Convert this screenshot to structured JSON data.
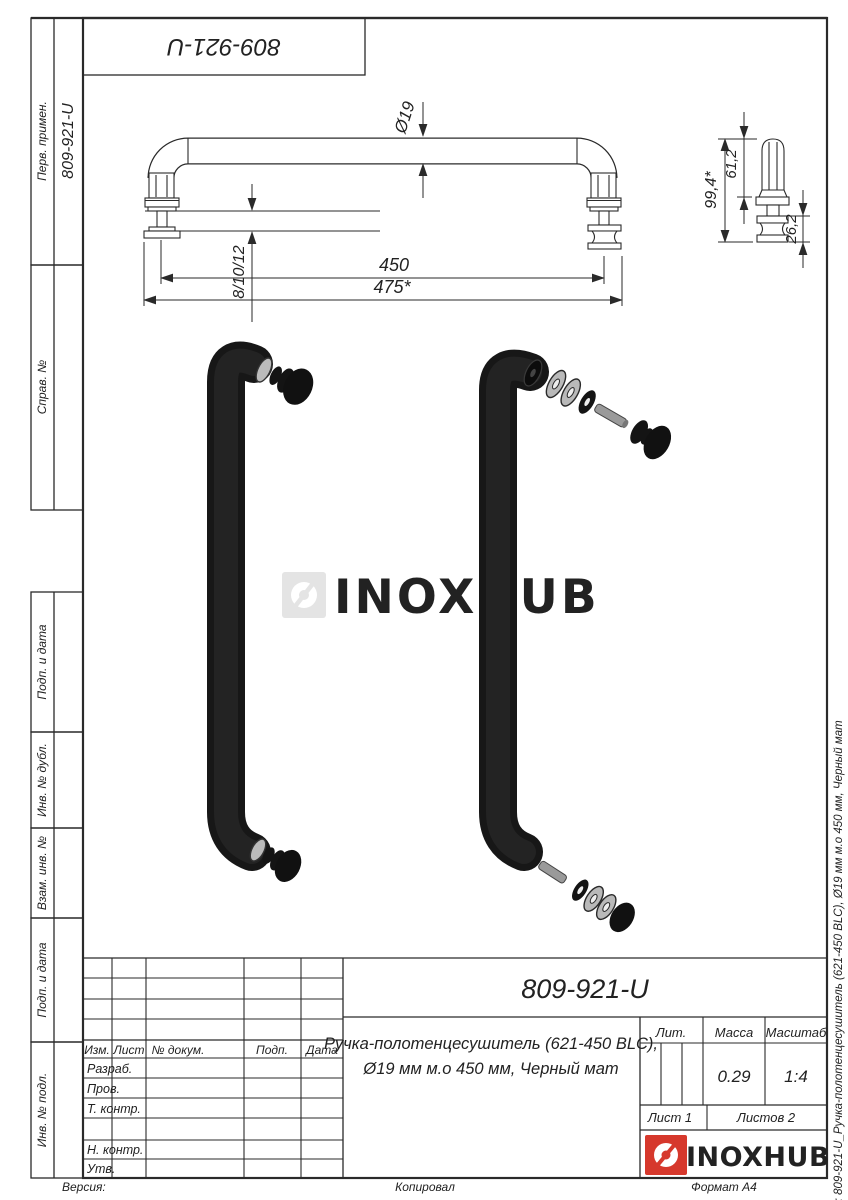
{
  "margins": {
    "top_box_code": "809-921-U",
    "left_sections": [
      {
        "label": "Перв. примен.",
        "value": "809-921-U"
      },
      {
        "label": "Справ. №",
        "value": ""
      },
      {
        "label": "Подп. и дата",
        "value": ""
      },
      {
        "label": "Инв. № дубл.",
        "value": ""
      },
      {
        "label": "Взам. инв. №",
        "value": ""
      },
      {
        "label": "Подп. и дата",
        "value": ""
      },
      {
        "label": "Инв. № подл.",
        "value": ""
      }
    ],
    "file_note": "Файл: 809-921-U_Ручка-полотенцесушитель (621-450 BLC), Ø19 мм м.о 450 мм, Черный мат",
    "bottom_left": "Версия:",
    "bottom_center": "Копировал",
    "bottom_right": "Формат А4"
  },
  "drawing": {
    "dims": {
      "diameter": "Ø19",
      "glass_thickness": "8/10/12",
      "mounting_distance": "450",
      "overall_length": "475*",
      "side_overall": "99,4*",
      "side_upper": "61,2",
      "side_knob": "26,2"
    }
  },
  "watermark": {
    "text": "INOXHUB",
    "color": "#e4e4e4"
  },
  "title_block": {
    "designation": "809-921-U",
    "description_line1": "Ручка-полотенцесушитель (621-450 BLC),",
    "description_line2": "Ø19 мм м.о 450 мм, Черный мат",
    "headers": {
      "izm": "Изм.",
      "list": "Лист",
      "doc": "№ докум.",
      "podp": "Подп.",
      "data": "Дата"
    },
    "rows": {
      "razrab": "Разраб.",
      "prov": "Пров.",
      "tkontr": "Т. контр.",
      "nkontr": "Н. контр.",
      "utv": "Утв."
    },
    "lit_label": "Лит.",
    "mass_label": "Масса",
    "scale_label": "Масштаб",
    "mass_value": "0.29",
    "scale_value": "1:4",
    "sheet": "Лист 1",
    "sheets": "Листов 2",
    "brand": "INOXHUB",
    "brand_color": "#d6382c",
    "line_color": "#2a2a2a"
  }
}
